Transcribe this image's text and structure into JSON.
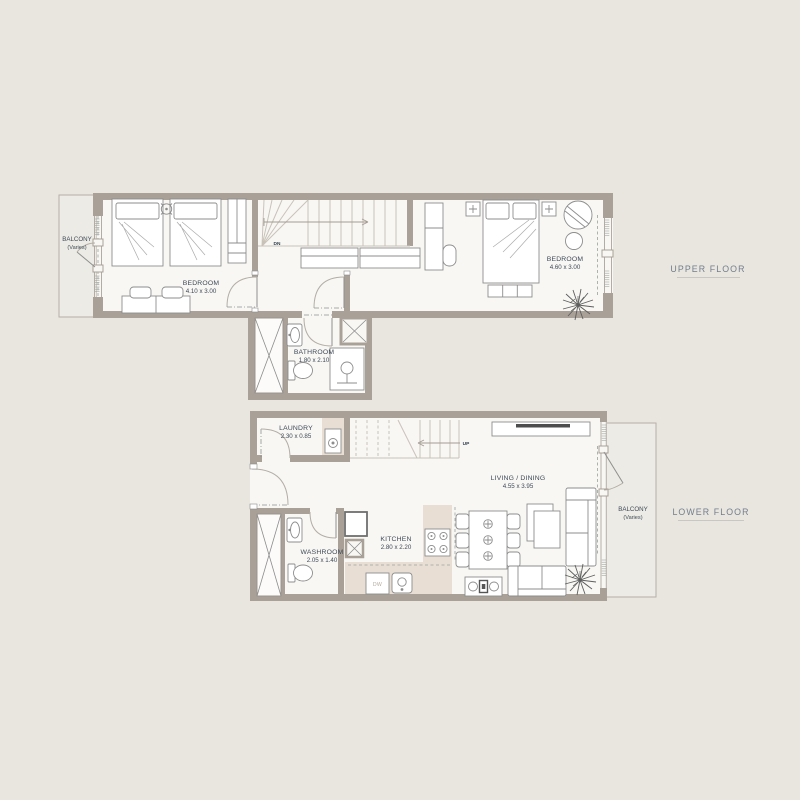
{
  "colors": {
    "background": "#e9e6e0",
    "wall": "#a9a097",
    "floor": "#f8f7f4",
    "balcony_floor": "#ecebe5",
    "counter": "#e8ded4",
    "room_label_text": "#3e4a57",
    "floor_label_text": "#727e8b"
  },
  "upper_floor": {
    "label": "UPPER FLOOR",
    "stair_direction": "DN",
    "rooms": {
      "balcony": {
        "name": "BALCONY",
        "note": "(Varies)"
      },
      "bedroom_1": {
        "name": "BEDROOM",
        "dims": "4.10 x 3.00"
      },
      "bedroom_2": {
        "name": "BEDROOM",
        "dims": "4.60 x 3.00"
      },
      "bathroom": {
        "name": "BATHROOM",
        "dims": "1.80 x 2.10"
      }
    }
  },
  "lower_floor": {
    "label": "LOWER FLOOR",
    "stair_direction": "UP",
    "appliance_labels": {
      "dishwasher": "DW"
    },
    "rooms": {
      "laundry": {
        "name": "LAUNDRY",
        "dims": "2.30 x 0.85"
      },
      "living_dining": {
        "name": "LIVING / DINING",
        "dims": "4.55 x 3.95"
      },
      "kitchen": {
        "name": "KITCHEN",
        "dims": "2.80 x 2.20"
      },
      "washroom": {
        "name": "WASHROOM",
        "dims": "2.05 x 1.40"
      },
      "balcony": {
        "name": "BALCONY",
        "note": "(Varies)"
      }
    }
  }
}
